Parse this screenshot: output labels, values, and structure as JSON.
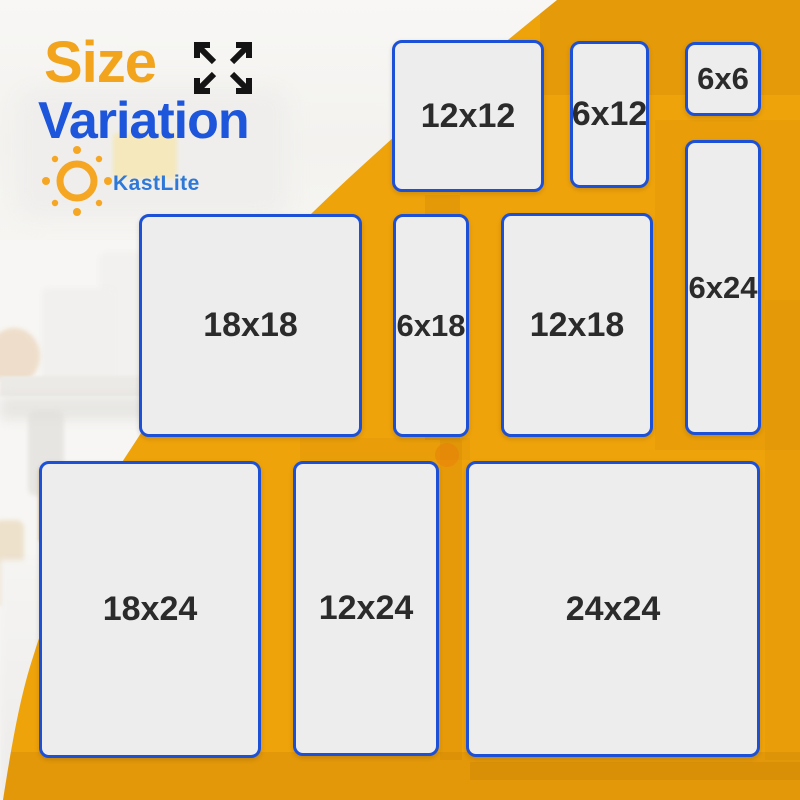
{
  "header": {
    "title_accent": "Size",
    "title_main": "Variation",
    "expand_icon": "expand-arrows-icon"
  },
  "brand": {
    "name": "KastLite",
    "logo_icon": "sun-icon"
  },
  "sizes": [
    "12x12",
    "6x12",
    "6x6",
    "6x24",
    "18x18",
    "6x18",
    "12x18",
    "18x24",
    "12x24",
    "24x24"
  ],
  "colors": {
    "accent_orange": "#F2A41D",
    "brand_blue": "#1D55DB",
    "background_yellow": "#EFA30B",
    "panel_fill": "#EDEDED",
    "panel_border": "#1C50D6",
    "label_text": "#2B2B2B"
  }
}
